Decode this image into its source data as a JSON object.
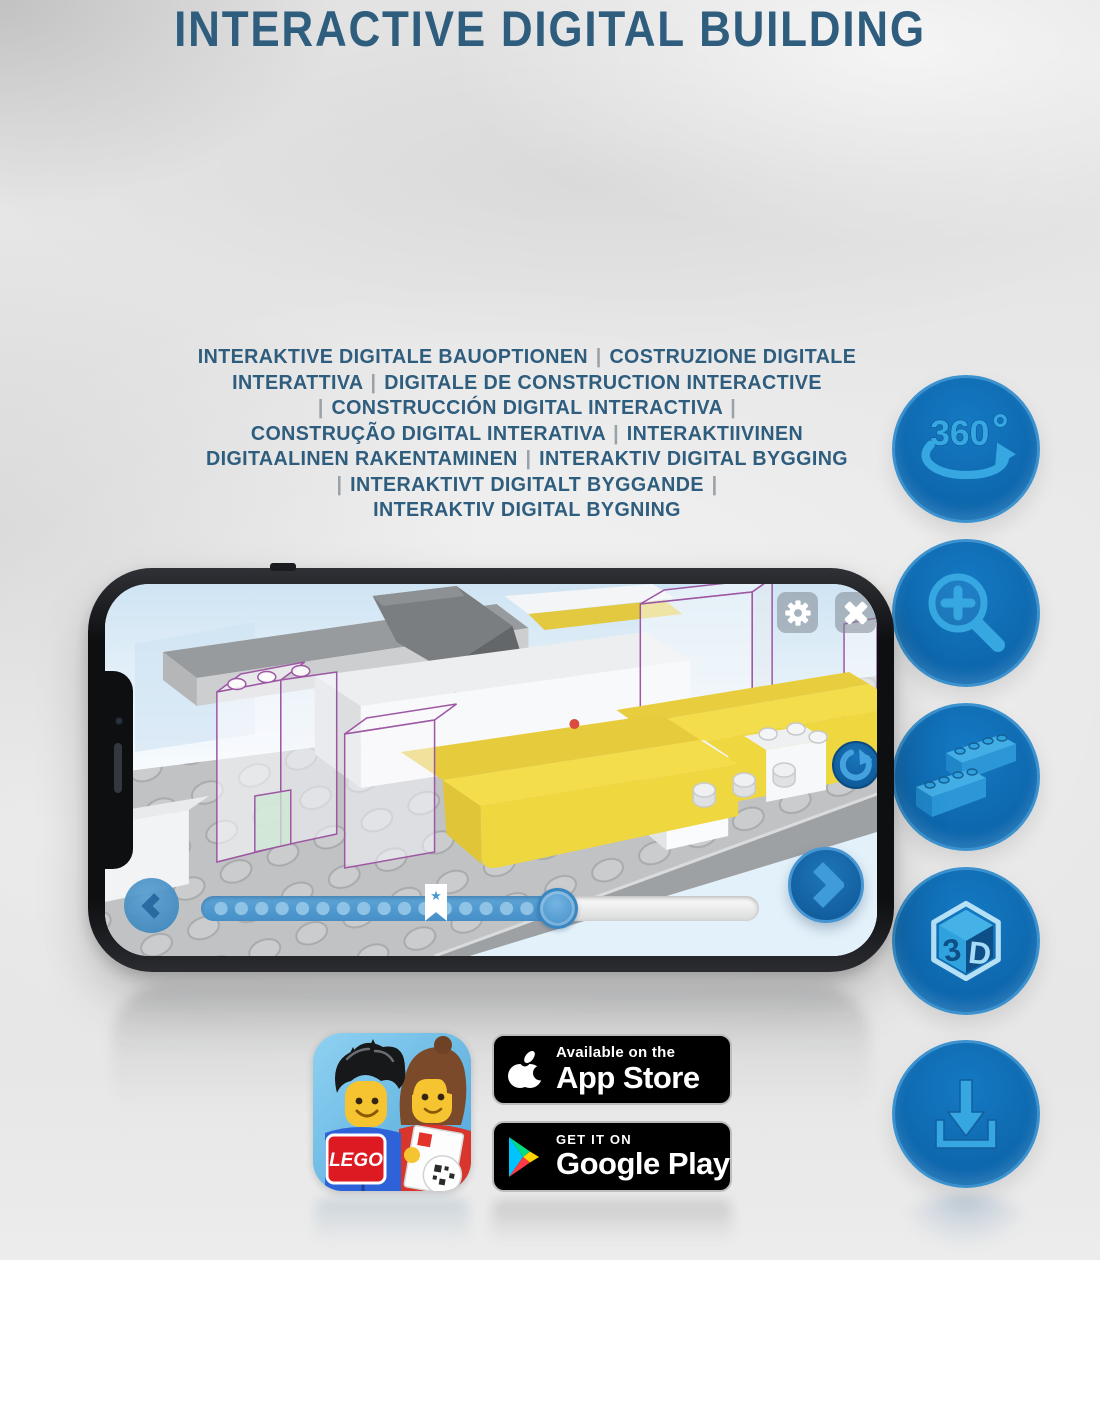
{
  "page_title": "INTERACTIVE DIGITAL BUILDING",
  "subtitle_lines": [
    "INTERAKTIVE DIGITALE BAUOPTIONEN | COSTRUZIONE DIGITALE",
    "INTERATTIVA | DIGITALE DE CONSTRUCTION INTERACTIVE",
    "| CONSTRUCCIÓN DIGITAL INTERACTIVA |",
    "CONSTRUÇÃO DIGITAL INTERATIVA | INTERAKTIIVINEN",
    "DIGITAALINEN RAKENTAMINEN | INTERAKTIV DIGITAL BYGGING",
    "| INTERAKTIVT DIGITALT BYGGANDE |",
    "INTERAKTIV DIGITAL BYGNING"
  ],
  "feature_icons": {
    "rotate360": {
      "name": "360-rotation-icon",
      "label": "360",
      "degree": "°"
    },
    "zoom": {
      "name": "zoom-in-icon"
    },
    "brick": {
      "name": "brick-stack-icon"
    },
    "threed": {
      "name": "3d-cube-icon",
      "digit": "3",
      "letter": "D"
    },
    "download": {
      "name": "download-icon"
    }
  },
  "phone": {
    "screen_controls": {
      "settings": "gear-icon",
      "close": "close-icon",
      "rotate_view": "rotate-cw-icon",
      "previous_step": "chevron-left-icon",
      "next_step": "chevron-right-icon",
      "bookmark_star": "★"
    },
    "progress_percent": 47,
    "step_dots_visible": 17
  },
  "badges": {
    "lego_app": {
      "logo_text": "LEGO"
    },
    "app_store": {
      "tagline": "Available on the",
      "store_name": "App Store"
    },
    "google_play": {
      "tagline": "GET IT ON",
      "store_name": "Google Play"
    }
  },
  "colors": {
    "heading_blue": "#2e5d7e",
    "icon_circle_blue": "#0f6cb4",
    "icon_glyph_blue": "#36a7e0",
    "brick_yellow": "#f3dd4a",
    "ghost_outline_purple": "#9d58a4",
    "badge_black": "#000000",
    "lego_red": "#dd1a21",
    "screen_sky": "#d6e9f6"
  }
}
